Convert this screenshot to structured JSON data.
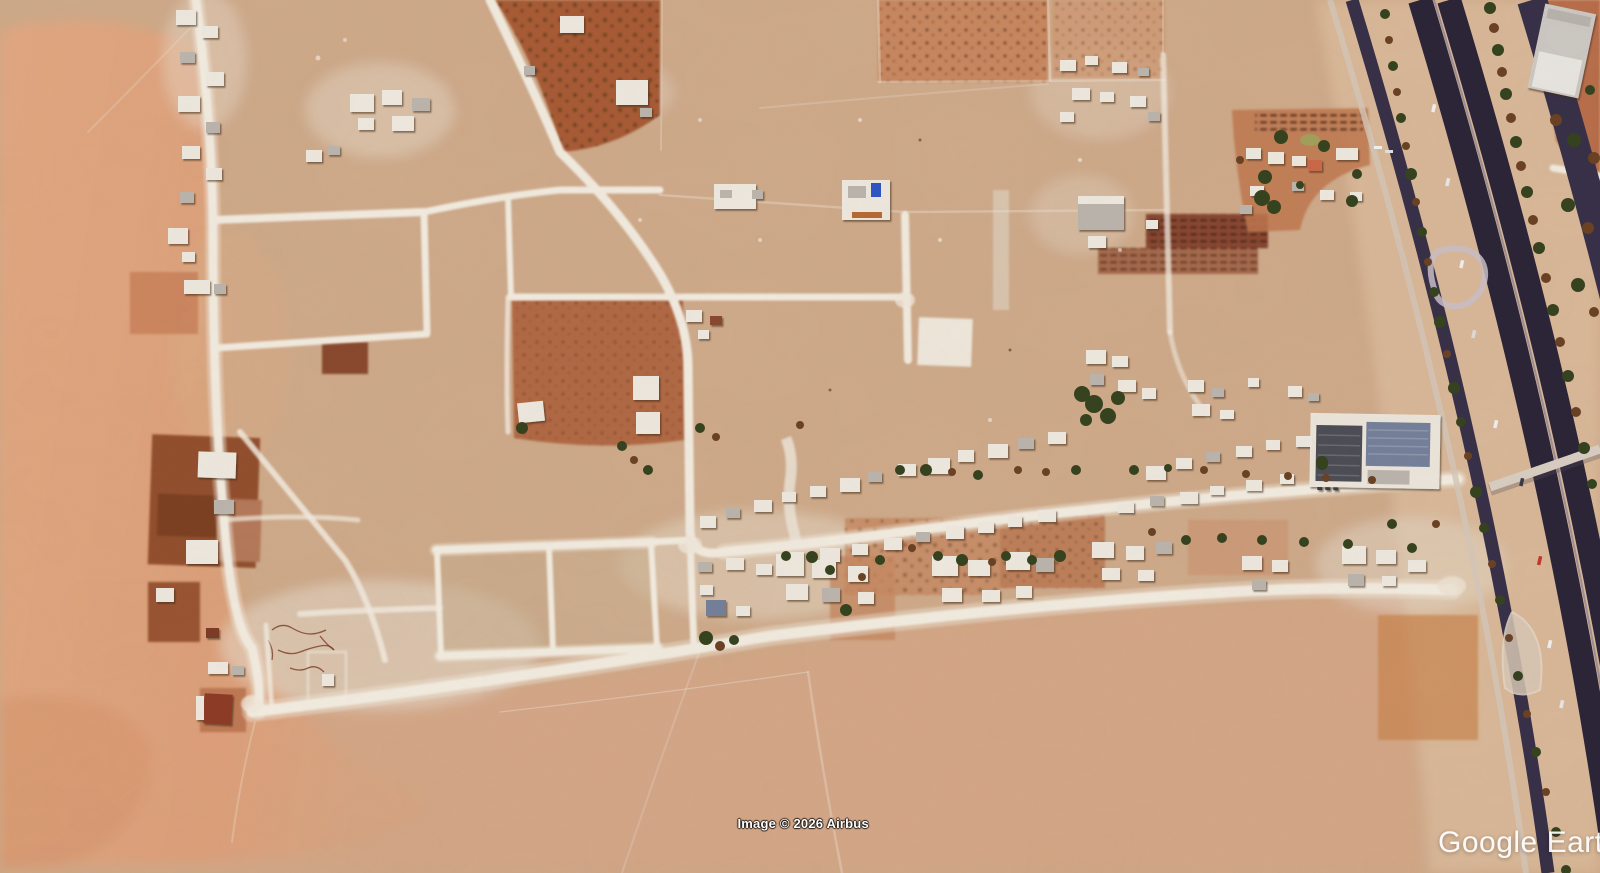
{
  "watermarks": {
    "attribution": "Image © 2026 Airbus",
    "logo": "Google Earth"
  },
  "palette": {
    "sand_base": "#cfab8b",
    "sand_left": "#e0a57e",
    "sand_bottom": "#d5a687",
    "road_white": "#f2ece1",
    "highway_dark": "#2c2537",
    "highway_mid": "#383048",
    "median_sand": "#dcbd9e",
    "tree_green": "#36431f",
    "tree_brown": "#6b4223",
    "field_red": "#b26a44",
    "field_dark": "#8a4730",
    "building_white": "#eee9e0",
    "building_gray": "#bcb6ae",
    "roof_blue": "#2e55c4",
    "roof_dark": "#4d4d55",
    "roof_bluegray": "#75819b",
    "attr_color": "#ffffff",
    "logo_color": "#ffffff"
  }
}
